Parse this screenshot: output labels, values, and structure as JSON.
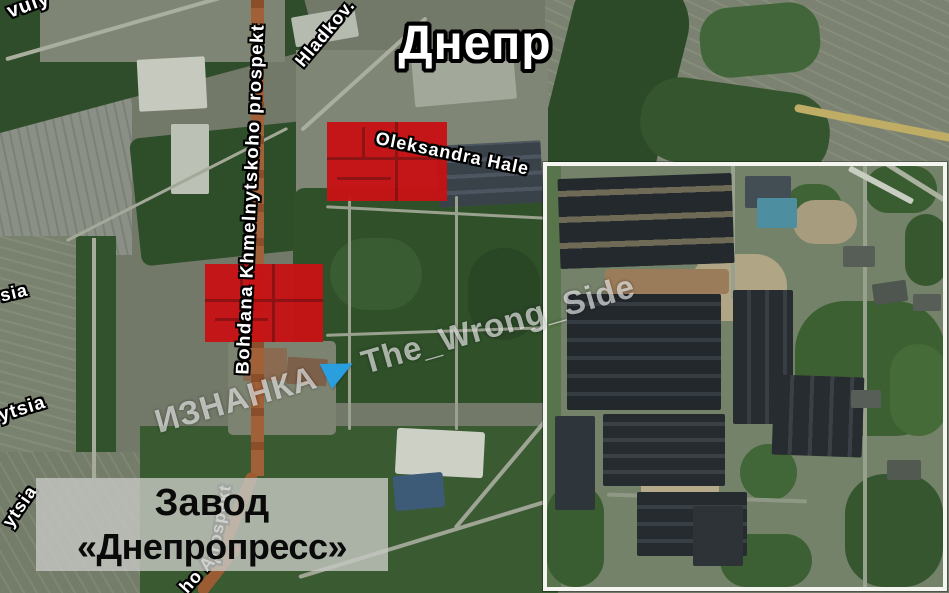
{
  "title": {
    "text": "Днепр"
  },
  "streets": {
    "vuly": "vuly",
    "hladkov": "Hladkov.",
    "bohdana": "Bohdana Khmelnytskoho prospekt",
    "oleksandra": "Oleksandra Hale",
    "sia": "sia",
    "ytsia_mid": "ytsia",
    "ytsia_low": "ytsia",
    "prospekt_fragment": "prospekt",
    "ho_fragment": "ho A"
  },
  "callout": {
    "line1": "Завод",
    "line2": "«Днепропресс»"
  },
  "watermark": {
    "name": "ИЗНАНКА",
    "handle": "The_Wrong_Side",
    "icon": "paper-plane"
  },
  "markers": {
    "red_zone_count": 2
  },
  "colors": {
    "red_zone": "#c81114",
    "red_zone_lines": "#8f0d10",
    "watermark_blue": "#2a9fe0",
    "callout_bg": "#c5c7c1",
    "road_orange": "#a06038",
    "inset_border": "#f4f4f0"
  }
}
